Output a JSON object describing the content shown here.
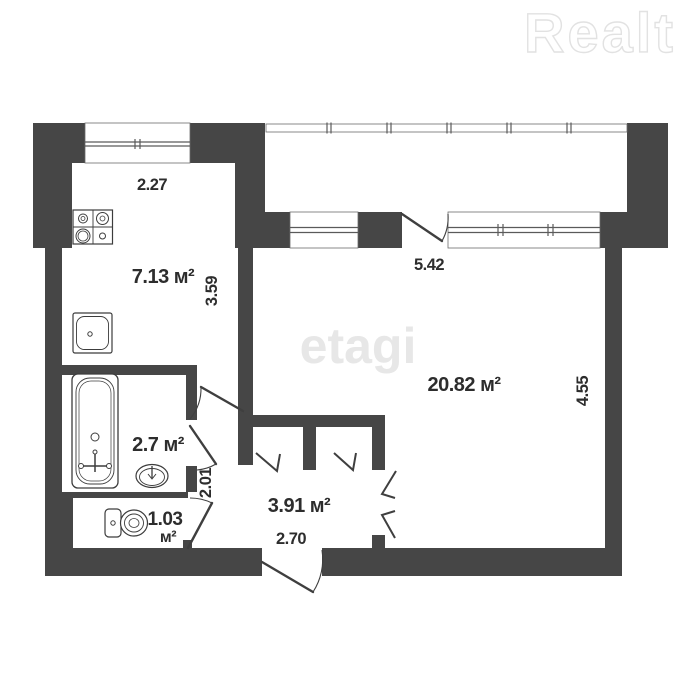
{
  "watermarks": {
    "realt": "Realt",
    "etagi": "etagi"
  },
  "rooms": {
    "kitchen": {
      "area": "7.13 м²",
      "width": "2.27",
      "depth": "3.59"
    },
    "living_room": {
      "area": "20.82 м²",
      "width": "5.42",
      "depth": "4.55"
    },
    "bathroom": {
      "area": "2.7 м²",
      "depth": "2.01"
    },
    "toilet": {
      "area_value": "1.03",
      "area_unit": "м²"
    },
    "hallway": {
      "area": "3.91 м²",
      "width": "2.70"
    }
  },
  "fixtures": {
    "stove": "stove-icon",
    "kitchen_sink": "sink-icon",
    "bathtub": "bathtub-icon",
    "wash_basin": "basin-icon",
    "toilet": "toilet-icon"
  },
  "colors": {
    "wall": "#464646",
    "line": "#3f3f3f",
    "text": "#2d2d2d",
    "watermark": "#e5e5e5",
    "background": "#ffffff"
  }
}
